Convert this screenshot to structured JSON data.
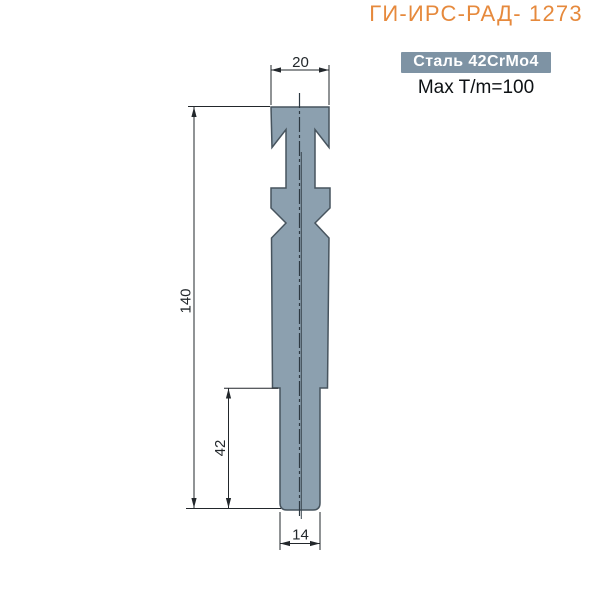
{
  "header": {
    "title": "ГИ-ИРС-РАД- 1273",
    "material_badge": "Сталь 42CrMo4",
    "max_load": "Max T/m=100"
  },
  "drawing": {
    "dimensions": {
      "top_width": "20",
      "total_height": "140",
      "lower_section_height": "42",
      "tip_width": "14"
    }
  },
  "colors": {
    "title": "#E6893C",
    "badge_bg": "#7E93A4",
    "badge_text": "#FFFFFF",
    "part_fill": "#8CA0AF",
    "part_stroke": "#47545E",
    "dim_stroke": "#22272B"
  }
}
